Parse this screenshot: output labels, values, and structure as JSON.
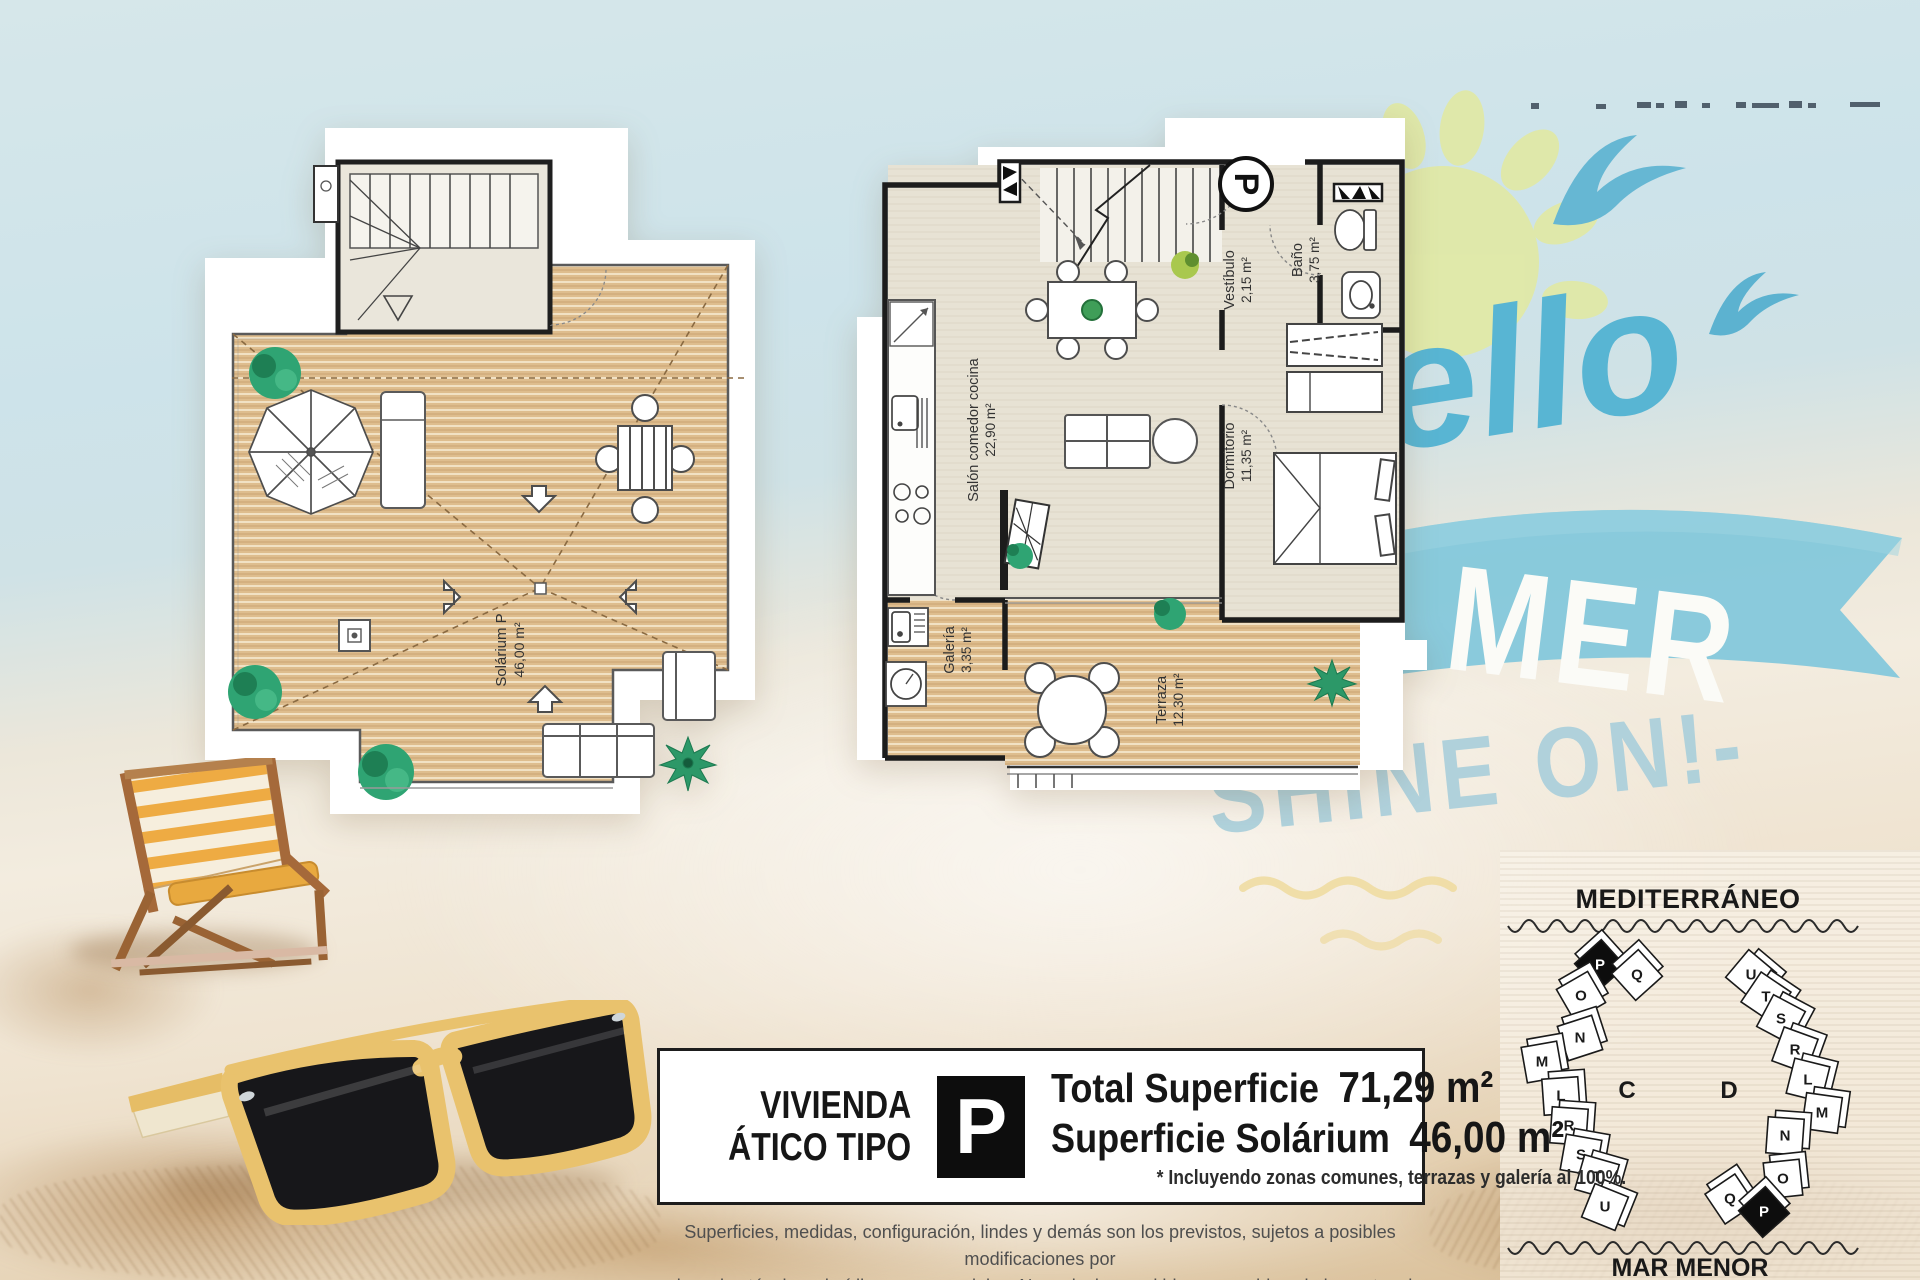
{
  "branding": {
    "script_word": "ello",
    "banner_word": "MER",
    "tagline": "SHINE ON!-"
  },
  "floor_plans": {
    "solarium": {
      "name": "Solárium P",
      "area": "46,00 m²"
    },
    "apartment": {
      "parking_marker": "P",
      "rooms": [
        {
          "name": "Salón comedor cocina",
          "area": "22,90 m²"
        },
        {
          "name": "Vestíbulo",
          "area": "2,15 m²"
        },
        {
          "name": "Baño",
          "area": "3,75 m²"
        },
        {
          "name": "Dormitorio",
          "area": "11,35 m²"
        },
        {
          "name": "Galería",
          "area": "3,35 m²"
        },
        {
          "name": "Terraza",
          "area": "12,30 m²"
        }
      ]
    }
  },
  "summary_box": {
    "dwelling_label_line1": "VIVIENDA",
    "dwelling_label_line2": "ÁTICO TIPO",
    "type_badge": "P",
    "total_surface_label": "Total Superficie",
    "total_surface_value": "71,29 m²",
    "solarium_surface_label": "Superficie Solárium",
    "solarium_surface_value": "46,00 m²",
    "footnote": "* Incluyendo zonas comunes, terrazas y galería al 100%."
  },
  "legal": {
    "line1": "Superficies, medidas, configuración, lindes y demás son los previstos, sujetos a posibles modificaciones por",
    "line2": "exigencias técnicas, jurídicas o comerciales. No se incluyen ni bienes muebles ni elementos de jardinería."
  },
  "site_plan": {
    "sea_north": "MEDITERRÁNEO",
    "sea_south": "MAR MENOR",
    "blocks": [
      {
        "label": "C",
        "units": [
          "P",
          "Q",
          "O",
          "N",
          "M",
          "L",
          "R",
          "S",
          "T",
          "U"
        ],
        "highlighted_unit": "P"
      },
      {
        "label": "D",
        "units": [
          "U",
          "T",
          "S",
          "R",
          "L",
          "M",
          "N",
          "O",
          "Q",
          "P"
        ],
        "highlighted_unit": "P"
      }
    ]
  },
  "colors": {
    "logo_blue": "#58b5d3",
    "banner_blue": "#84c8db",
    "tagline_blue": "#a7cedb",
    "sun_yellow": "#e0e9a7",
    "deck_wood": "#debd8e",
    "badge_black": "#0d0d0d"
  }
}
